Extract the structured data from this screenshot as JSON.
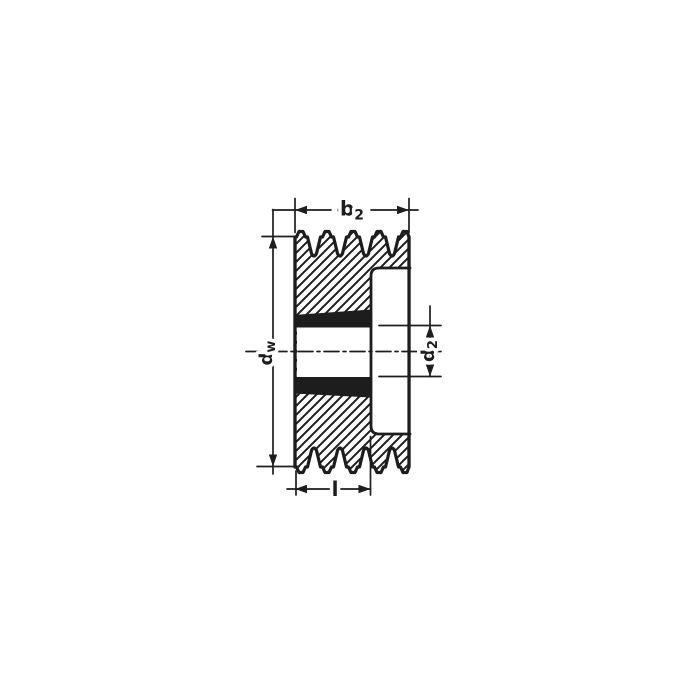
{
  "drawing": {
    "labels": {
      "b2": {
        "base": "b",
        "sub": "2"
      },
      "dw": {
        "base": "d",
        "sub": "w"
      },
      "d2": {
        "base": "d",
        "sub": "2"
      },
      "l": {
        "base": "l"
      }
    },
    "colors": {
      "ink": "#1d1d1d",
      "background": "#ffffff"
    }
  }
}
